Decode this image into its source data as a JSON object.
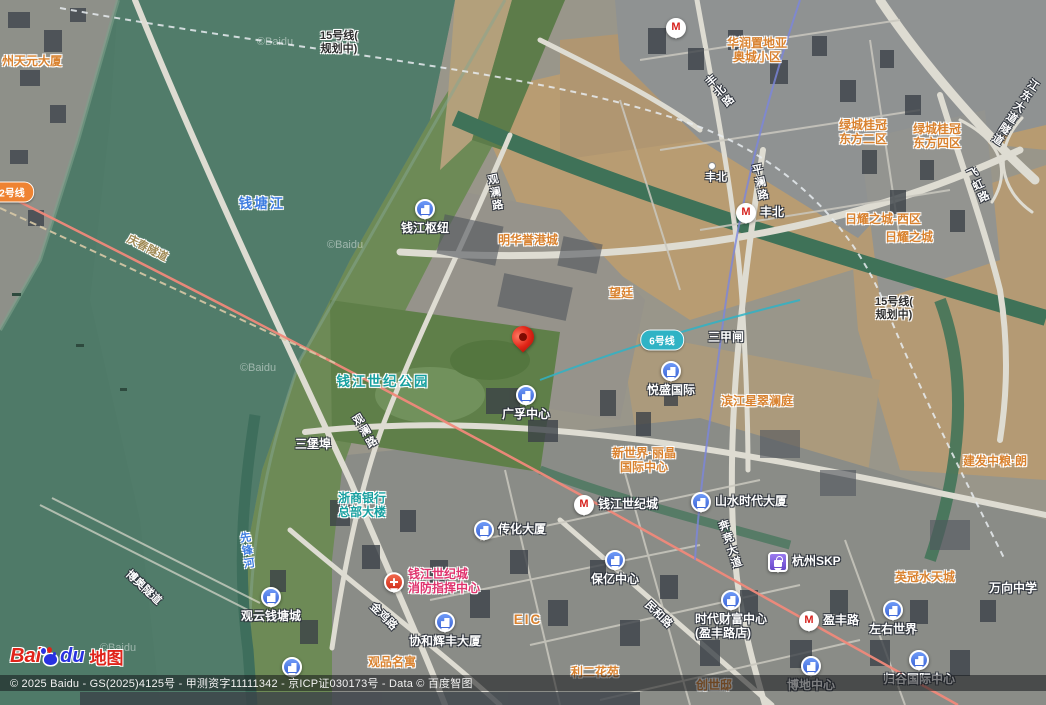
{
  "map": {
    "copyright": "© 2025 Baidu - GS(2025)4125号 - 甲测资字11111342 - 京ICP证030173号 - Data © 百度智图",
    "watermark": "©Baidu",
    "logo_bai": "Bai",
    "logo_du": "du",
    "logo_suffix": "地图"
  },
  "colors": {
    "river": "#4f7a68",
    "farmland": "#b89c72",
    "park": "#66854f",
    "poi_icon_blue": "#4a7df0",
    "metro_red": "#d6231f",
    "label_orange": "#d9822f",
    "label_teal": "#17a0a0",
    "water_label_blue": "#3d7ce0",
    "fire_label_pink": "#e0336e",
    "line2_pill": "#ef8332",
    "line6_pill": "#2fb3c5"
  },
  "transit": {
    "line2_pill": "2号线",
    "line6_pill": "6号线",
    "line15_note": {
      "line1": "15号线(",
      "line2": "规划中)"
    }
  },
  "water": {
    "qiantang_river": "钱塘江",
    "xianfeng_river": "先锋河"
  },
  "roads": {
    "guanlan": "观澜路",
    "fengbei_road": "丰北路",
    "pinglan": "平澜路",
    "benjing": "奔竞大道",
    "jinji": "金鸡路",
    "minhe": "民和路",
    "feihong": "飞虹路",
    "jiangdong_tunnel": "江东大道隧道",
    "qingchun_tunnel": "庆春隧道",
    "boao_tunnel": "博奥隧道"
  },
  "places": {
    "tianyuan": "州天元大厦",
    "minghua": "明华誉港城",
    "wangting": "望廷",
    "huarun": {
      "line1": "华润置地亚",
      "line2": "奥城小区"
    },
    "lvcheng2": {
      "line1": "绿城桂冠",
      "line2": "东方二区"
    },
    "lvcheng4": {
      "line1": "绿城桂冠",
      "line2": "东方四区"
    },
    "riyao_west": "日耀之城-西区",
    "riyao": "日耀之城",
    "sanjiazha": "三甲闸",
    "century_park": "钱江世纪公园",
    "sanbaobu": "三堡埠",
    "xingcui": "滨江星翠澜庭",
    "new_world": {
      "line1": "新世界·丽晶",
      "line2": "国际中心"
    },
    "zheshang": {
      "line1": "浙商银行",
      "line2": "总部大楼"
    },
    "fire_center": {
      "line1": "钱江世纪城",
      "line2": "消防指挥中心"
    },
    "eic": "EIC",
    "yingguan": "英冠水天城",
    "wanxiang": "万向中学",
    "lier": "利二花苑",
    "chuangshidi": "创世邸",
    "jianfa": "建发中粮·朗",
    "guanpin": "观品名寓"
  },
  "pois": {
    "qianjiang_hub": "钱江枢纽",
    "guangfu": "广孚中心",
    "yuesheng": "悦盛国际",
    "shanshui": "山水时代大厦",
    "chuanhua": "传化大厦",
    "baoyi": "保亿中心",
    "xiehe": "协和辉丰大厦",
    "guanyun": "观云钱塘城",
    "times_wealth": {
      "line1": "时代财富中心",
      "line2": "(盈丰路店)"
    },
    "zuoyou": "左右世界",
    "bodi": "博地中心",
    "guigu": "归谷国际中心",
    "skp": "杭州SKP"
  },
  "stations": {
    "fengbei": "丰北",
    "fengbei_entrance": "丰北",
    "century_city": "钱江世纪城",
    "yingfeng": "盈丰路"
  }
}
